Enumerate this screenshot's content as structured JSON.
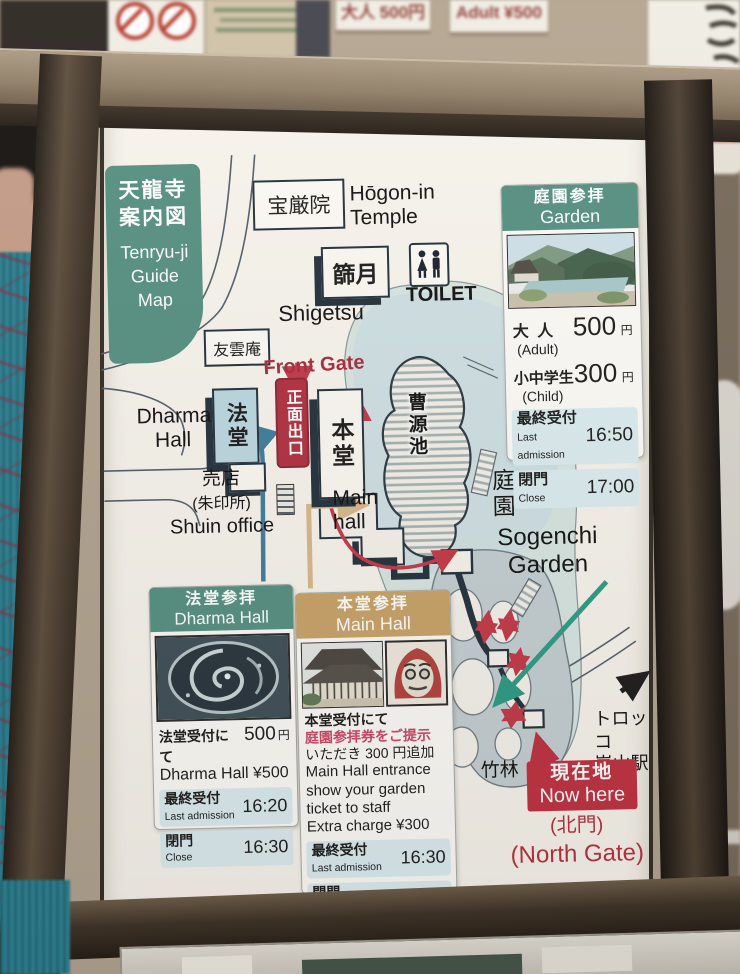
{
  "colors": {
    "teal_header": "#559082",
    "red_badge": "#bf3542",
    "red_text": "#b02e3e",
    "tan_header": "#c9a368",
    "dark_outline": "#22303c",
    "route_red": "#c33848",
    "route_teal": "#2d9b85",
    "route_blue": "#3f7d9c",
    "route_tan": "#d9b98c"
  },
  "surroundings": {
    "price_ja": "大人 500円",
    "price_en": "Adult ¥500"
  },
  "title": {
    "ja1": "天龍寺",
    "ja2": "案内図",
    "en1": "Tenryu-ji",
    "en2": "Guide",
    "en3": "Map"
  },
  "map": {
    "hogonin_ja": "宝厳院",
    "hogonin_en1": "Hōgon-in",
    "hogonin_en2": "Temple",
    "shigetsu_ja": "篩月",
    "shigetsu_en": "Shigetsu",
    "toilet": "TOILET",
    "yuunan_ja": "友雲庵",
    "front_gate_en": "Front Gate",
    "front_gate_ja": "正面出口",
    "hodo_ja": "法堂",
    "dharma1": "Dharma",
    "dharma2": "Hall",
    "hondo_ja": "本堂",
    "main1": "Main",
    "main2": "hall",
    "shop_ja": "売店",
    "shop_ja2": "(朱印所)",
    "shop_en": "Shuin office",
    "pond_ja": "曹源池",
    "teien_ja": "庭園",
    "sogenchi1": "Sogenchi",
    "sogenchi2": "Garden",
    "bamboo_ja": "竹林",
    "torokko1": "トロッコ",
    "torokko2": "嵐山駅"
  },
  "garden_box": {
    "header_ja": "庭園参拝",
    "header_en": "Garden",
    "adult_ja": "大 人",
    "adult_price": "500",
    "adult_unit": "円",
    "adult_en": "(Adult)",
    "child_ja": "小中学生",
    "child_price": "300",
    "child_unit": "円",
    "child_en": "(Child)",
    "last_ja": "最終受付",
    "last_en": "Last admission",
    "last_time": "16:50",
    "close_ja": "閉門",
    "close_en": "Close",
    "close_time": "17:00"
  },
  "dharma_box": {
    "header_ja": "法堂参拝",
    "header_en": "Dharma Hall",
    "price_ja": "法堂受付にて",
    "price_value": "500",
    "price_unit": "円",
    "price_en": "Dharma Hall ¥500",
    "last_ja": "最終受付",
    "last_en": "Last admission",
    "last_time": "16:20",
    "close_ja": "閉門",
    "close_en": "Close",
    "close_time": "16:30"
  },
  "main_box": {
    "header_ja": "本堂参拝",
    "header_en": "Main Hall",
    "note_ja1": "本堂受付にて",
    "note_ja2": "庭園参拝券をご提示",
    "note_ja3": "いただき 300 円追加",
    "note_en1": "Main Hall entrance",
    "note_en2": "show your garden",
    "note_en3": "ticket to staff",
    "note_en4": "Extra charge ¥300",
    "last_ja": "最終受付",
    "last_en": "Last admission",
    "last_time": "16:30",
    "close_ja": "閉門",
    "close_en": "Close",
    "close_time": "16:45"
  },
  "now_here": {
    "ja": "現在地",
    "en": "Now here",
    "gate_ja": "(北門)",
    "gate_en": "(North Gate)"
  }
}
